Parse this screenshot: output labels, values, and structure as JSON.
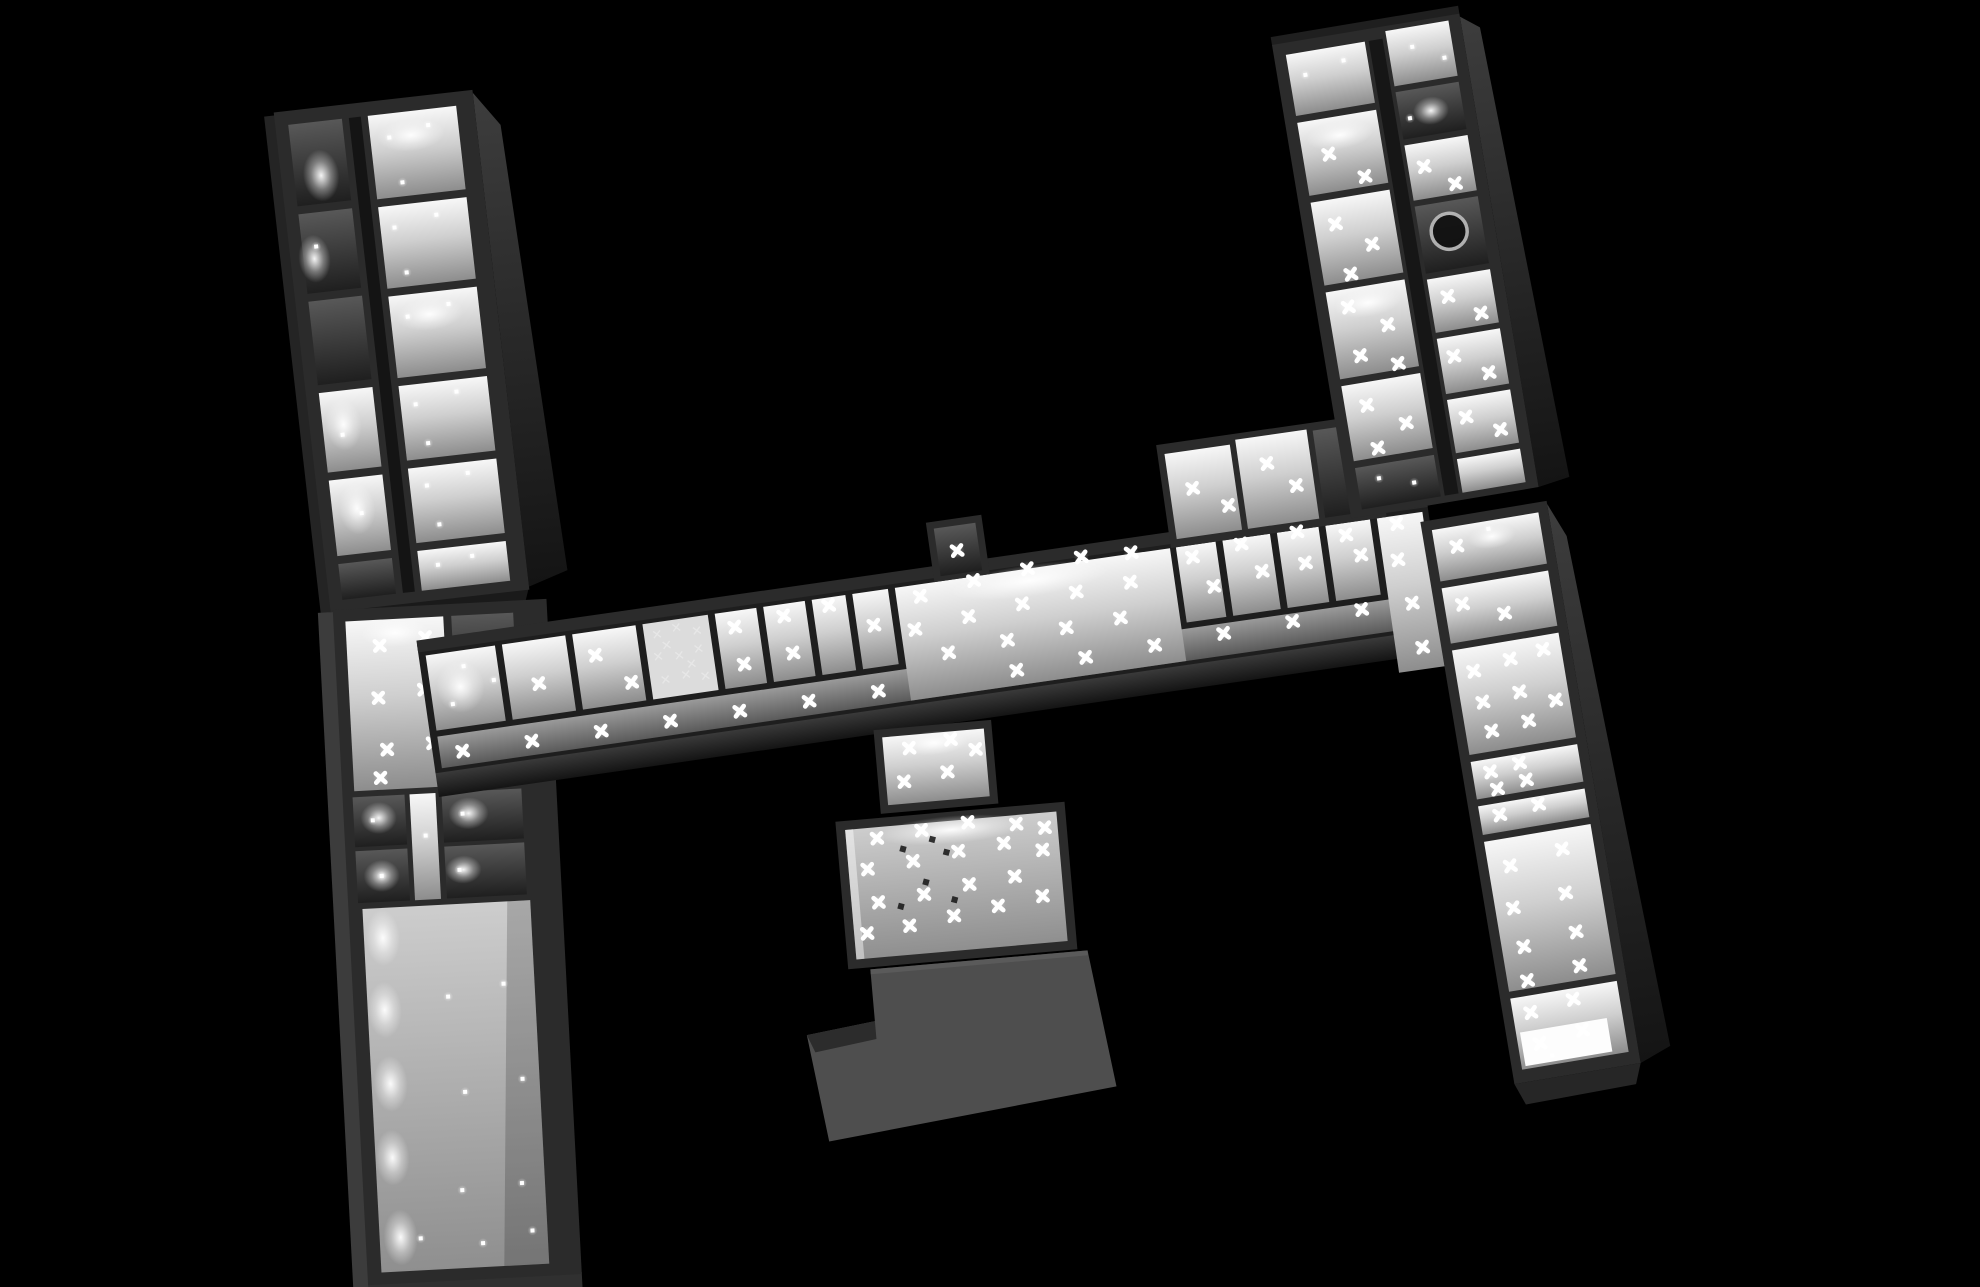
{
  "meta": {
    "description": "Grayscale 3D overhead dollhouse rendering of an H-shaped building: four tilted room wings connected by a long central corridor, illuminated rooms with white cross-shaped light markers on a black background"
  },
  "colors": {
    "background": "#000000",
    "wall": "#2b2b2b",
    "wall_dark": "#1e1e1e",
    "wall_face_light": "#3d3d3d",
    "floor_bright": "#f7f7f7",
    "floor_mid": "#8d8d8d",
    "hall_floor": "#cdcdcd",
    "roof_block": "#4e4e4e",
    "marker": "#ffffff"
  },
  "markers": {
    "tlw": {
      "dots": [
        [
          390,
          150
        ],
        [
          430,
          142
        ],
        [
          398,
          196
        ],
        [
          385,
          240
        ],
        [
          428,
          232
        ],
        [
          392,
          286
        ],
        [
          388,
          330
        ],
        [
          430,
          322
        ],
        [
          386,
          418
        ],
        [
          428,
          410
        ],
        [
          394,
          458
        ],
        [
          388,
          500
        ],
        [
          430,
          492
        ],
        [
          396,
          540
        ],
        [
          390,
          580
        ],
        [
          425,
          575
        ],
        [
          310,
          440
        ],
        [
          320,
          520
        ],
        [
          305,
          250
        ]
      ]
    },
    "blw": {
      "xmarks": [
        [
          378,
          648
        ],
        [
          424,
          642
        ],
        [
          374,
          700
        ],
        [
          420,
          694
        ],
        [
          380,
          752
        ],
        [
          426,
          748
        ],
        [
          372,
          780
        ]
      ],
      "dots": [
        [
          362,
          822
        ],
        [
          368,
          878
        ],
        [
          452,
          820
        ],
        [
          446,
          876
        ],
        [
          414,
          840
        ],
        [
          428,
          1002
        ],
        [
          484,
          992
        ],
        [
          440,
          1098
        ],
        [
          498,
          1088
        ],
        [
          432,
          1196
        ],
        [
          492,
          1192
        ],
        [
          388,
          1242
        ],
        [
          450,
          1250
        ],
        [
          500,
          1240
        ]
      ]
    },
    "corridor": {
      "xmarks": [
        [
          540,
          700
        ],
        [
          600,
          680
        ],
        [
          632,
          712
        ],
        [
          742,
          672
        ],
        [
          746,
          710
        ],
        [
          792,
          668
        ],
        [
          796,
          706
        ],
        [
          838,
          664
        ],
        [
          880,
          690
        ],
        [
          1205,
          668
        ],
        [
          1222,
          700
        ],
        [
          1255,
          662
        ],
        [
          1272,
          692
        ],
        [
          1312,
          658
        ],
        [
          1316,
          690
        ],
        [
          1360,
          668
        ],
        [
          1372,
          690
        ],
        [
          1412,
          664
        ],
        [
          1408,
          700
        ],
        [
          1416,
          745
        ],
        [
          1420,
          790
        ],
        [
          1215,
          600
        ],
        [
          1248,
          622
        ],
        [
          1292,
          586
        ],
        [
          1318,
          612
        ],
        [
          455,
          756
        ],
        [
          525,
          756
        ],
        [
          595,
          756
        ],
        [
          665,
          756
        ],
        [
          735,
          756
        ],
        [
          805,
          756
        ],
        [
          875,
          756
        ],
        [
          1015,
          755
        ],
        [
          1085,
          752
        ],
        [
          1155,
          750
        ],
        [
          1225,
          748
        ],
        [
          1295,
          746
        ],
        [
          1365,
          744
        ],
        [
          930,
          668
        ],
        [
          985,
          660
        ],
        [
          1040,
          656
        ],
        [
          1095,
          652
        ],
        [
          1145,
          655
        ],
        [
          920,
          700
        ],
        [
          975,
          695
        ],
        [
          1030,
          690
        ],
        [
          1085,
          686
        ],
        [
          1140,
          684
        ],
        [
          950,
          728
        ],
        [
          1010,
          724
        ],
        [
          1070,
          720
        ],
        [
          1125,
          718
        ],
        [
          973,
          628
        ]
      ],
      "dots": [
        [
          468,
          672
        ],
        [
          452,
          708
        ],
        [
          496,
          690
        ]
      ],
      "scribbles": [
        [
          664,
          668
        ],
        [
          684,
          664
        ],
        [
          704,
          670
        ],
        [
          662,
          690
        ],
        [
          683,
          692
        ],
        [
          703,
          688
        ],
        [
          666,
          714
        ],
        [
          687,
          712
        ],
        [
          706,
          716
        ],
        [
          694,
          702
        ],
        [
          672,
          680
        ]
      ]
    },
    "central": {
      "xmarks": [
        [
          920,
          745
        ],
        [
          962,
          740
        ],
        [
          912,
          778
        ],
        [
          956,
          772
        ],
        [
          986,
          752
        ],
        [
          880,
          832
        ],
        [
          925,
          828
        ],
        [
          972,
          824
        ],
        [
          1020,
          830
        ],
        [
          1048,
          836
        ],
        [
          868,
          862
        ],
        [
          914,
          858
        ],
        [
          960,
          852
        ],
        [
          1006,
          848
        ],
        [
          1044,
          858
        ],
        [
          876,
          896
        ],
        [
          922,
          892
        ],
        [
          968,
          886
        ],
        [
          1014,
          882
        ],
        [
          862,
          926
        ],
        [
          905,
          922
        ],
        [
          950,
          916
        ],
        [
          995,
          910
        ],
        [
          1040,
          904
        ]
      ],
      "darkmarks": [
        [
          905,
          845
        ],
        [
          948,
          852
        ],
        [
          925,
          880
        ],
        [
          952,
          900
        ],
        [
          898,
          902
        ],
        [
          935,
          838
        ]
      ]
    },
    "trw": {
      "xmarks": [
        [
          1310,
          162
        ],
        [
          1342,
          190
        ],
        [
          1305,
          232
        ],
        [
          1338,
          258
        ],
        [
          1312,
          284
        ],
        [
          1304,
          316
        ],
        [
          1340,
          340
        ],
        [
          1308,
          366
        ],
        [
          1344,
          380
        ],
        [
          1306,
          416
        ],
        [
          1342,
          440
        ],
        [
          1310,
          460
        ],
        [
          1402,
          190
        ],
        [
          1430,
          212
        ],
        [
          1404,
          322
        ],
        [
          1434,
          344
        ],
        [
          1400,
          382
        ],
        [
          1432,
          404
        ],
        [
          1402,
          444
        ],
        [
          1434,
          462
        ]
      ],
      "dots": [
        [
          1300,
          80
        ],
        [
          1340,
          72
        ],
        [
          1410,
          70
        ],
        [
          1440,
          86
        ],
        [
          1396,
          140
        ],
        [
          1306,
          490
        ],
        [
          1340,
          500
        ]
      ]
    },
    "brw": {
      "xmarks": [
        [
          1452,
          552
        ],
        [
          1448,
          610
        ],
        [
          1488,
          626
        ],
        [
          1448,
          678
        ],
        [
          1486,
          672
        ],
        [
          1520,
          668
        ],
        [
          1452,
          710
        ],
        [
          1490,
          706
        ],
        [
          1456,
          740
        ],
        [
          1494,
          736
        ],
        [
          1524,
          720
        ],
        [
          1448,
          780
        ],
        [
          1478,
          776
        ],
        [
          1452,
          798
        ],
        [
          1482,
          794
        ],
        [
          1450,
          824
        ],
        [
          1490,
          820
        ],
        [
          1452,
          876
        ],
        [
          1506,
          868
        ],
        [
          1448,
          918
        ],
        [
          1502,
          912
        ],
        [
          1452,
          958
        ],
        [
          1506,
          952
        ],
        [
          1450,
          992
        ],
        [
          1504,
          986
        ],
        [
          1448,
          1024
        ],
        [
          1492,
          1018
        ],
        [
          1452,
          1056
        ],
        [
          1496,
          1050
        ]
      ],
      "dots": [
        [
          1486,
          540
        ],
        [
          1462,
          1070
        ]
      ]
    }
  }
}
